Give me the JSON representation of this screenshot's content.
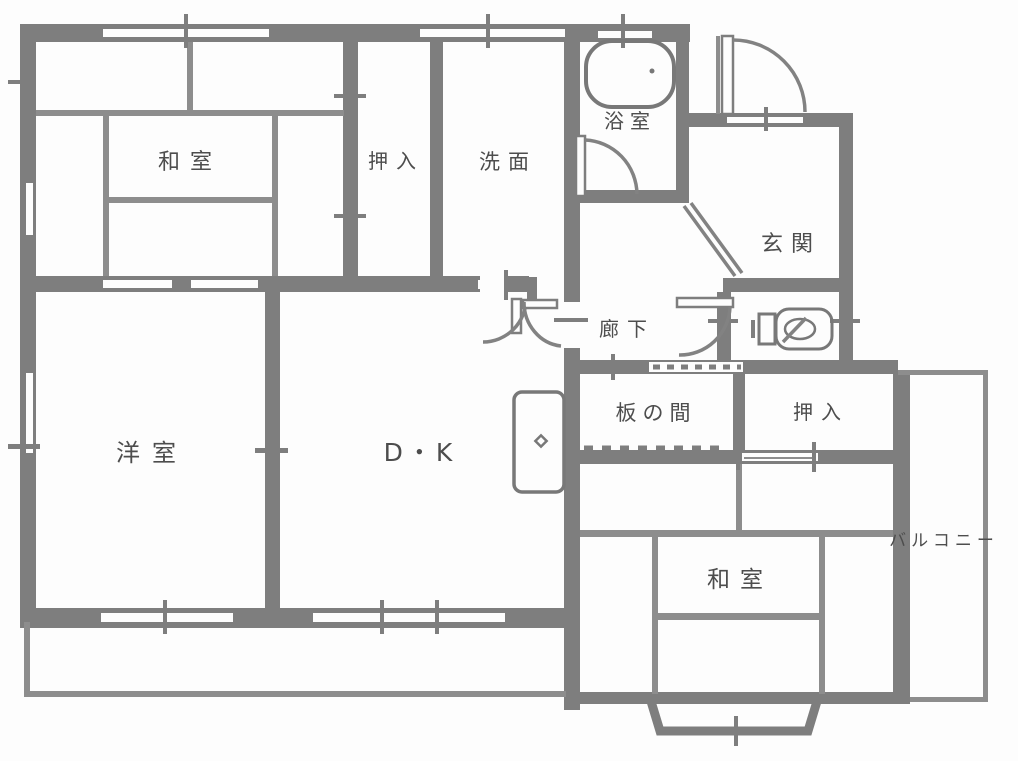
{
  "rooms": {
    "washitsu_nw": {
      "label": "和室"
    },
    "oshiire_north": {
      "label": "押入"
    },
    "senmen": {
      "label": "洗面"
    },
    "yokushitsu": {
      "label": "浴室"
    },
    "genkan": {
      "label": "玄関"
    },
    "rouka": {
      "label": "廊下"
    },
    "itanoma": {
      "label": "板の間"
    },
    "oshiire_east": {
      "label": "押入"
    },
    "washitsu_se": {
      "label": "和室"
    },
    "youshitsu": {
      "label": "洋室"
    },
    "dining_kitchen": {
      "label": "D・K"
    },
    "balcony": {
      "label": "バルコニー"
    }
  },
  "fixtures": {
    "bathtub": "bathtub-icon",
    "toilet": "toilet-icon",
    "kitchen_sink": "kitchen-sink-icon"
  },
  "colors": {
    "wall": "#7e7e7e",
    "thin_line": "#8d8d8d",
    "label_text": "#4d4d4d",
    "background": "#fdfdfd"
  }
}
